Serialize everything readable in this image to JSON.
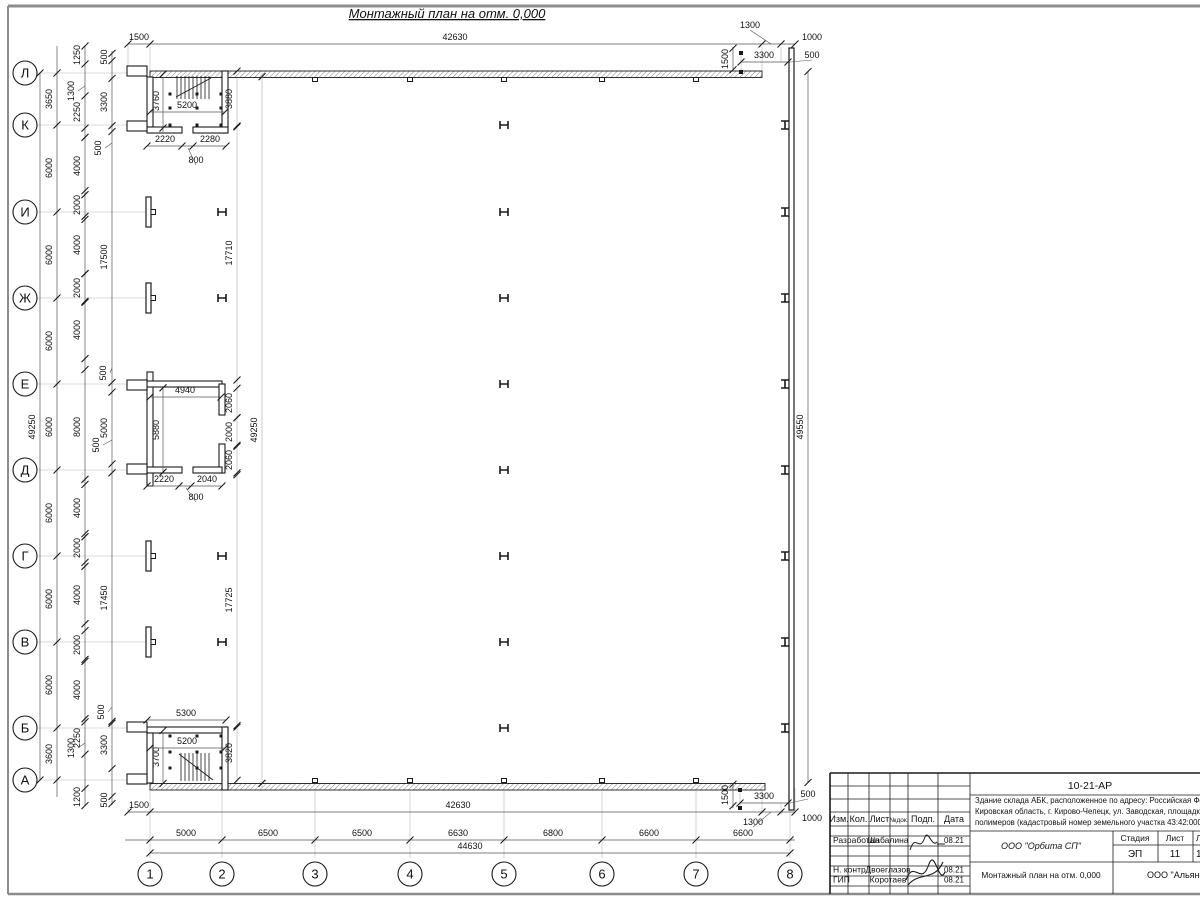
{
  "sheet": {
    "title": "Монтажный план на отм. 0,000",
    "bg": "#ffffff",
    "frame_color": "#8c8c8c",
    "line_color": "#1a1a1a",
    "light_color": "#b8b8b8",
    "hatch_color": "#8a8a8a"
  },
  "axes": {
    "rows": [
      {
        "label": "Л",
        "y": 73
      },
      {
        "label": "К",
        "y": 125
      },
      {
        "label": "И",
        "y": 212
      },
      {
        "label": "Ж",
        "y": 298
      },
      {
        "label": "Е",
        "y": 384
      },
      {
        "label": "Д",
        "y": 470
      },
      {
        "label": "Г",
        "y": 556
      },
      {
        "label": "В",
        "y": 642
      },
      {
        "label": "Б",
        "y": 728
      },
      {
        "label": "А",
        "y": 780
      }
    ],
    "cols": [
      {
        "label": "1",
        "x": 150
      },
      {
        "label": "2",
        "x": 222
      },
      {
        "label": "3",
        "x": 315
      },
      {
        "label": "4",
        "x": 410
      },
      {
        "label": "5",
        "x": 504
      },
      {
        "label": "6",
        "x": 602
      },
      {
        "label": "7",
        "x": 696
      },
      {
        "label": "8",
        "x": 790
      }
    ]
  },
  "dims": {
    "vertical": [
      {
        "x": 40,
        "y1": 73,
        "y2": 780,
        "tx": 35,
        "ticks": [
          73,
          780
        ],
        "items": [
          {
            "v": "49250",
            "c": 427
          }
        ]
      },
      {
        "x": 57,
        "y1": 46,
        "y2": 797,
        "tx": 52,
        "ticks": "rows",
        "items": [
          {
            "v": "3650",
            "c": 99
          },
          {
            "v": "6000",
            "c": 168
          },
          {
            "v": "6000",
            "c": 255
          },
          {
            "v": "6000",
            "c": 341
          },
          {
            "v": "6000",
            "c": 427
          },
          {
            "v": "6000",
            "c": 513
          },
          {
            "v": "6000",
            "c": 599
          },
          {
            "v": "6000",
            "c": 685
          },
          {
            "v": "3600",
            "c": 754
          }
        ]
      },
      {
        "x": 85,
        "y1": 46,
        "y2": 805,
        "tx": 80,
        "items": [
          {
            "v": "1250",
            "c": 55
          },
          {
            "v": "2250",
            "c": 112
          },
          {
            "v": "4000",
            "c": 166
          },
          {
            "v": "2000",
            "c": 205
          },
          {
            "v": "4000",
            "c": 245
          },
          {
            "v": "2000",
            "c": 288
          },
          {
            "v": "4000",
            "c": 330
          },
          {
            "v": "8000",
            "c": 427
          },
          {
            "v": "4000",
            "c": 508
          },
          {
            "v": "2000",
            "c": 548
          },
          {
            "v": "4000",
            "c": 595
          },
          {
            "v": "2000",
            "c": 645
          },
          {
            "v": "4000",
            "c": 690
          },
          {
            "v": "2250",
            "c": 738
          },
          {
            "v": "1200",
            "c": 797
          }
        ],
        "leaders": [
          {
            "v": "1300",
            "x": 74,
            "y": 91
          },
          {
            "v": "1300",
            "x": 74,
            "y": 748
          }
        ]
      },
      {
        "x": 112,
        "y1": 51,
        "y2": 805,
        "tx": 107,
        "items": [
          {
            "v": "500",
            "c": 57
          },
          {
            "v": "3300",
            "c": 102
          },
          {
            "v": "17500",
            "c": 257
          },
          {
            "v": "5000",
            "c": 428
          },
          {
            "v": "17450",
            "c": 598
          },
          {
            "v": "3300",
            "c": 745
          },
          {
            "v": "500",
            "c": 800
          }
        ],
        "leaders": [
          {
            "v": "500",
            "x": 101,
            "y": 148
          },
          {
            "v": "500",
            "x": 106,
            "y": 373
          },
          {
            "v": "500",
            "x": 99,
            "y": 445
          },
          {
            "v": "500",
            "x": 104,
            "y": 712
          }
        ]
      },
      {
        "x": 237,
        "y1": 78,
        "y2": 783,
        "tx": 232,
        "light": true,
        "items": [
          {
            "v": "3880",
            "c": 99
          },
          {
            "v": "17710",
            "c": 253
          },
          {
            "v": "2060",
            "c": 403
          },
          {
            "v": "2000",
            "c": 432
          },
          {
            "v": "2060",
            "c": 460
          },
          {
            "v": "17725",
            "c": 600
          },
          {
            "v": "3820",
            "c": 753
          }
        ]
      },
      {
        "x": 262,
        "y1": 73,
        "y2": 788,
        "tx": 257,
        "light": true,
        "items": [
          {
            "v": "49250",
            "c": 430
          }
        ]
      },
      {
        "x": 808,
        "y1": 71,
        "y2": 783,
        "tx": 803,
        "items": [
          {
            "v": "49550",
            "c": 427
          }
        ]
      },
      {
        "x": 163,
        "y1": 78,
        "y2": 132,
        "tx": 159,
        "items": [
          {
            "v": "3760",
            "c": 101
          }
        ]
      },
      {
        "x": 163,
        "y1": 388,
        "y2": 472,
        "tx": 159,
        "items": [
          {
            "v": "5880",
            "c": 430
          }
        ]
      },
      {
        "x": 163,
        "y1": 733,
        "y2": 784,
        "tx": 159,
        "items": [
          {
            "v": "3700",
            "c": 757
          }
        ]
      },
      {
        "x": 733,
        "y1": 47,
        "y2": 71,
        "tx": 728,
        "items": [
          {
            "v": "1500",
            "c": 59
          }
        ]
      },
      {
        "x": 733,
        "y1": 783,
        "y2": 808,
        "tx": 728,
        "items": [
          {
            "v": "1500",
            "c": 795
          }
        ]
      }
    ],
    "horizontal": [
      {
        "y": 44,
        "x1": 128,
        "x2": 795,
        "ticks": [
          128,
          150,
          762,
          781,
          795
        ],
        "items": [
          {
            "v": "1500",
            "c": 139
          },
          {
            "v": "42630",
            "c": 455
          },
          {
            "v": "1000",
            "c": 812
          }
        ],
        "leaders": [
          {
            "v": "1300",
            "x": 750,
            "y": 28,
            "lx": 771,
            "ly": 44
          }
        ]
      },
      {
        "y": 62,
        "x1": 741,
        "x2": 788,
        "ticks": [
          741,
          788
        ],
        "items": [
          {
            "v": "3300",
            "c": 764
          }
        ],
        "leaders": [
          {
            "v": "500",
            "x": 812,
            "y": 58,
            "lx": 790,
            "ly": 62
          }
        ]
      },
      {
        "y": 812,
        "x1": 128,
        "x2": 795,
        "ticks": [
          128,
          150,
          762,
          781,
          795
        ],
        "items": [
          {
            "v": "1500",
            "c": 139
          },
          {
            "v": "42630",
            "c": 458
          },
          {
            "v": "1000",
            "c": 812,
            "ty": 821
          }
        ],
        "leaders": [
          {
            "v": "1300",
            "x": 753,
            "y": 825,
            "lx": 771,
            "ly": 812
          }
        ]
      },
      {
        "y": 803,
        "x1": 740,
        "x2": 788,
        "ticks": [
          740,
          788
        ],
        "items": [
          {
            "v": "3300",
            "c": 764
          }
        ],
        "leaders": [
          {
            "v": "500",
            "x": 808,
            "y": 797,
            "lx": 790,
            "ly": 803
          }
        ]
      },
      {
        "y": 840,
        "x1": 125,
        "x2": 795,
        "ticks": "cols",
        "items": [
          {
            "v": "5000",
            "c": 186
          },
          {
            "v": "6500",
            "c": 268
          },
          {
            "v": "6500",
            "c": 362
          },
          {
            "v": "6630",
            "c": 458
          },
          {
            "v": "6800",
            "c": 553
          },
          {
            "v": "6600",
            "c": 649
          },
          {
            "v": "6600",
            "c": 743
          }
        ]
      },
      {
        "y": 853,
        "x1": 150,
        "x2": 790,
        "ticks": [
          150,
          790
        ],
        "items": [
          {
            "v": "44630",
            "c": 470
          }
        ]
      },
      {
        "y": 112,
        "x1": 150,
        "x2": 225,
        "ticks": [
          150,
          225
        ],
        "items": [
          {
            "v": "5200",
            "c": 187
          }
        ]
      },
      {
        "y": 146,
        "x1": 147,
        "x2": 226,
        "ticks": [
          147,
          182,
          193,
          226
        ],
        "items": [
          {
            "v": "2220",
            "c": 165
          },
          {
            "v": "2280",
            "c": 210
          }
        ],
        "leaders": [
          {
            "v": "800",
            "x": 196,
            "y": 163,
            "lx": 188,
            "ly": 148
          }
        ]
      },
      {
        "y": 397,
        "x1": 150,
        "x2": 221,
        "ticks": [
          150,
          221
        ],
        "items": [
          {
            "v": "4940",
            "c": 185
          }
        ]
      },
      {
        "y": 486,
        "x1": 147,
        "x2": 222,
        "ticks": [
          147,
          179,
          191,
          222
        ],
        "items": [
          {
            "v": "2220",
            "c": 164
          },
          {
            "v": "2040",
            "c": 207
          }
        ],
        "leaders": [
          {
            "v": "800",
            "x": 196,
            "y": 500,
            "lx": 186,
            "ly": 488
          }
        ]
      },
      {
        "y": 720,
        "x1": 147,
        "x2": 226,
        "ticks": [
          147,
          226
        ],
        "items": [
          {
            "v": "5300",
            "c": 186
          }
        ]
      },
      {
        "y": 748,
        "x1": 150,
        "x2": 225,
        "ticks": [
          150,
          225
        ],
        "items": [
          {
            "v": "5200",
            "c": 187
          }
        ]
      }
    ]
  },
  "titleblock": {
    "doc_number": "10-21-АР",
    "address_lines": [
      "Здание склада АБК, расположенное по адресу: Российская Феде",
      "Кировская область, г. Кирово-Чепецк, ул. Заводская, площадка з",
      "полимеров (кадастровый номер земельного участка 43:42:0000"
    ],
    "org_design": "ООО \"Орбита СП\"",
    "org_right": "ООО \"Альянс",
    "drawing_name": "Монтажный план на отм. 0,000",
    "stage_label": "Стадия",
    "sheet_label": "Лист",
    "sheets_label": "Листов",
    "stage": "ЭП",
    "sheet_no": "11",
    "sheets_total": "1",
    "header_cols": [
      "Изм.",
      "Кол.",
      "Лист",
      "№док.",
      "Подп.",
      "Дата"
    ],
    "rows": [
      {
        "role": "Разработал",
        "name": "Шабалина",
        "date": "08.21"
      },
      {
        "role": "Н. контр.",
        "name": "Двоеглазов",
        "date": "08.21"
      },
      {
        "role": "ГИП",
        "name": "Коротаев",
        "date": "08.21"
      }
    ]
  }
}
